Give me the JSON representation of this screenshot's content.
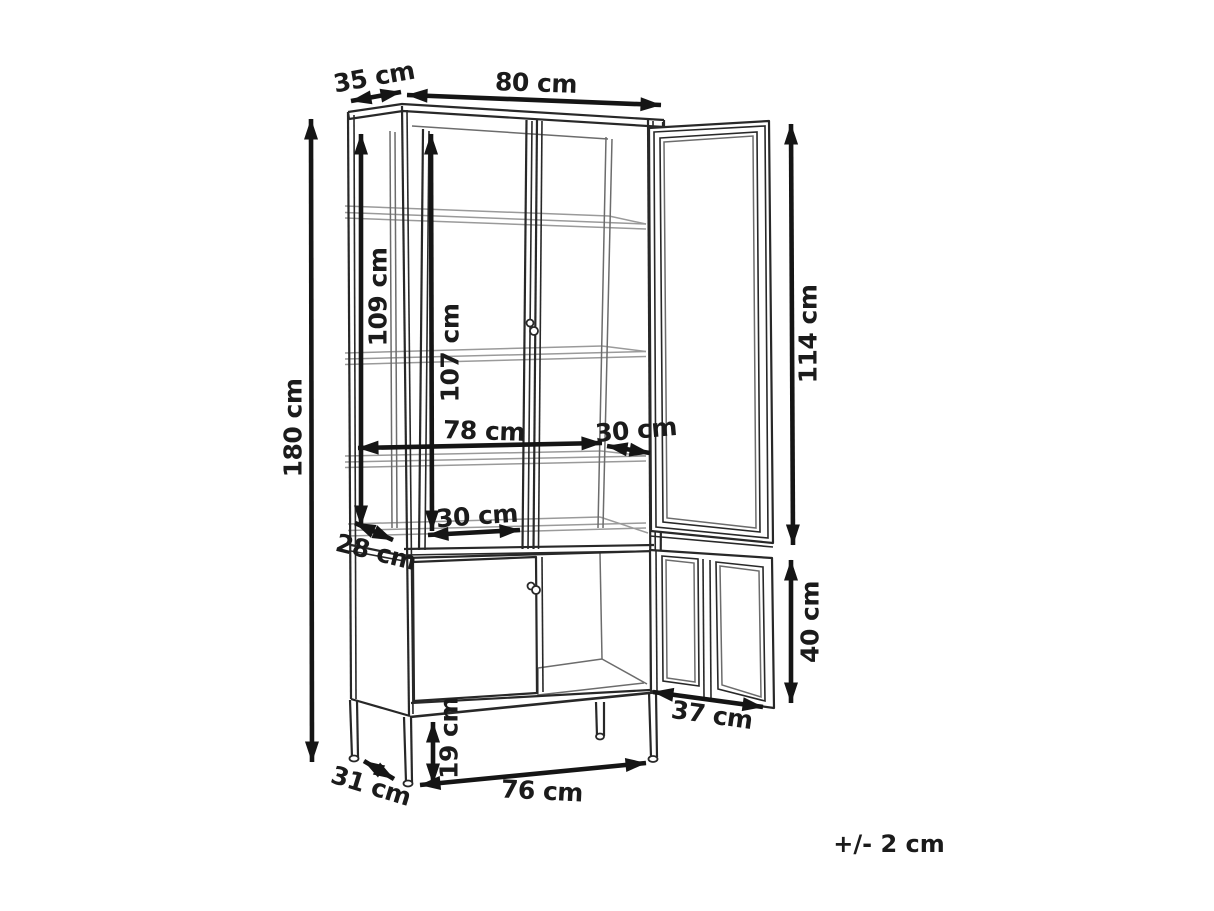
{
  "drawing": {
    "type": "furniture-dimension-diagram",
    "subject": "display cabinet with glass doors, open right doors",
    "unit": "cm",
    "background_color": "#ffffff",
    "line_color": "#282828",
    "interior_line_color": "#6c6c6c",
    "shelf_line_color": "#9a9a9a",
    "arrow_color": "#151515",
    "label_color": "#1b1b1b"
  },
  "dimensions": {
    "top_depth": "35 cm",
    "top_width": "80 cm",
    "total_height": "180 cm",
    "glass_side_height": "109 cm",
    "glass_front_height": "107 cm",
    "glass_door_height": "114 cm",
    "interior_width": "78 cm",
    "shelf_depth_right": "30 cm",
    "shelf_depth_left": "30 cm",
    "mid_depth": "28 cm",
    "lower_door_height": "40 cm",
    "lower_door_width": "37 cm",
    "base_depth": "31 cm",
    "leg_height": "19 cm",
    "base_width": "76 cm"
  },
  "note": {
    "tolerance": "+/- 2 cm"
  }
}
